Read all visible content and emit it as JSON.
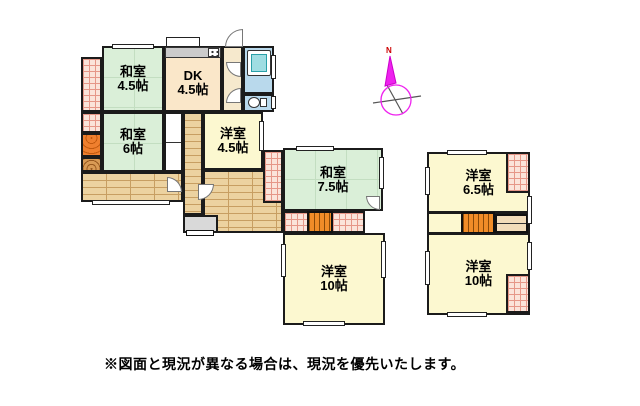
{
  "floorplan": {
    "rooms": [
      {
        "name": "和室",
        "size": "4.5帖"
      },
      {
        "name": "DK",
        "size": "4.5帖"
      },
      {
        "name": "和室",
        "size": "6帖"
      },
      {
        "name": "洋室",
        "size": "4.5帖"
      },
      {
        "name": "和室",
        "size": "7.5帖"
      },
      {
        "name": "洋室",
        "size": "10帖"
      },
      {
        "name": "洋室",
        "size": "6.5帖"
      },
      {
        "name": "洋室",
        "size": "10帖"
      }
    ],
    "compass": {
      "north_label": "N"
    },
    "note": "※図面と現況が異なる場合は、現況を優先いたします。",
    "colors": {
      "tatami_room": "#daefd8",
      "western_room": "#fcf8d0",
      "dk_room": "#fae7c9",
      "bathroom": "#b9d9ec",
      "wood_floor": "#ecd2a0",
      "tile_floor": "#fbe4da",
      "stairs": "#f08c28",
      "tokonoma": "#ef7f2e",
      "compass_needle": "#ee22ee",
      "north_text": "#cc0000",
      "wall": "#1b1b1b"
    },
    "icons": {
      "compass": "compass-needle-icon",
      "stove": "stove-burner-icon",
      "bathtub": "bathtub-icon",
      "toilet": "toilet-icon"
    }
  }
}
